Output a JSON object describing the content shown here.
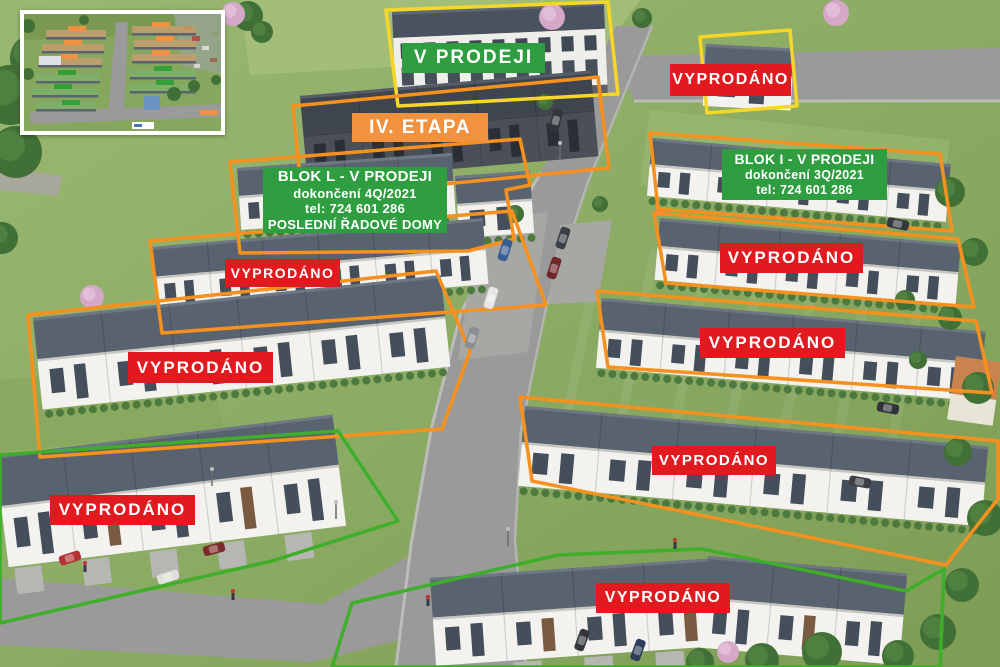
{
  "badges": [
    {
      "id": "v-prodeji-top",
      "label": "V PRODEJI",
      "variant": "green"
    },
    {
      "id": "vyprodano-top-right",
      "label": "VYPRODÁNO",
      "variant": "red"
    },
    {
      "id": "iv-etapa",
      "label": "IV. ETAPA",
      "variant": "orange"
    },
    {
      "id": "vyprodano-left-upper",
      "label": "VYPRODÁNO",
      "variant": "red"
    },
    {
      "id": "vyprodano-left-middle",
      "label": "VYPRODÁNO",
      "variant": "red"
    },
    {
      "id": "vyprodano-left-bottom",
      "label": "VYPRODÁNO",
      "variant": "red"
    },
    {
      "id": "vyprodano-right-upper",
      "label": "VYPRODÁNO",
      "variant": "red"
    },
    {
      "id": "vyprodano-right-middle",
      "label": "VYPRODÁNO",
      "variant": "red"
    },
    {
      "id": "vyprodano-right-lower",
      "label": "VYPRODÁNO",
      "variant": "red"
    },
    {
      "id": "vyprodano-bottom-center",
      "label": "VYPRODÁNO",
      "variant": "red"
    }
  ],
  "info_labels": {
    "blok_l": {
      "lines": [
        "BLOK L - V PRODEJI",
        "dokončení 4Q/2021",
        "tel: 724 601 286",
        "POSLEDNÍ ŘADOVÉ DOMY"
      ]
    },
    "blok_i": {
      "lines": [
        "BLOK I - V PRODEJI",
        "dokončení 3Q/2021",
        "tel: 724 601 286"
      ]
    }
  },
  "colors": {
    "status_green": "#2f9e41",
    "status_red": "#e11a20",
    "status_orange": "#f0923f",
    "outline_orange": "#f6911f",
    "outline_yellow": "#f6d728",
    "outline_green": "#3fae2a"
  }
}
